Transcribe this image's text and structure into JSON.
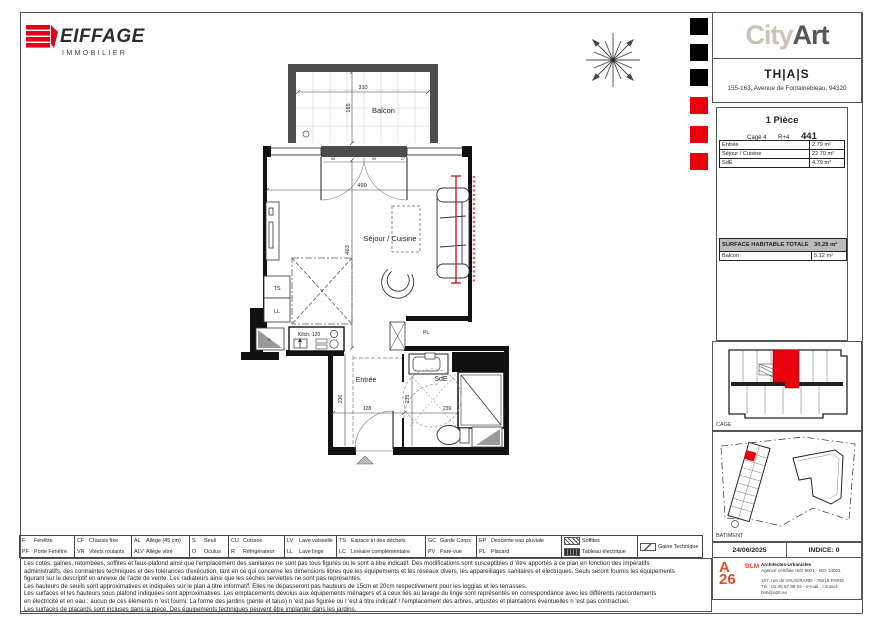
{
  "brand": {
    "name": "EIFFAGE",
    "sub": "IMMOBILIER"
  },
  "project": {
    "name_light": "City",
    "name_dark": "Art",
    "residence": "TH|A|S",
    "address": "155-163, Avenue de Fontainebleau, 94320"
  },
  "unit": {
    "type": "1 Pièce",
    "cage": "Cage 4",
    "floor": "R+4",
    "number": "441",
    "rooms": [
      {
        "name": "Entrée",
        "area": "2.79 m²"
      },
      {
        "name": "Séjour / Cuisine",
        "area": "22.70 m²"
      },
      {
        "name": "SdE",
        "area": "4.79 m²"
      }
    ],
    "total_label": "SURFACE HABITABLE TOTALE",
    "total_area": "30.28 m²",
    "balcony_label": "Balcon",
    "balcony_area": "5.12 m²"
  },
  "plan": {
    "rooms": {
      "balcon": "Balcon",
      "sejour": "Séjour / Cuisine",
      "entree": "Entrée",
      "sde": "SdE"
    },
    "tags": {
      "ts": "TS",
      "ll": "LL",
      "pl": "PL",
      "s": "S",
      "kitchen": "Kitch. 120"
    },
    "dims": {
      "balcon_w": "310",
      "balcon_d": "165",
      "sejour_w": "499",
      "sejour_d": "463",
      "entree_d": "236",
      "entree_w": "128",
      "sde_d": "235",
      "sde_w": "239",
      "bay_1": "98",
      "bay_2": "90",
      "bay_3": "27"
    }
  },
  "keyplans": {
    "cage_label": "CAGE",
    "batiment_label": "BATIMENT"
  },
  "titleblock": {
    "date": "24/06/2025",
    "indice": "INDICE: 0"
  },
  "architect": {
    "logo_a": "A",
    "logo_26": "26",
    "blm": "BLM",
    "line1": "Architectes-Urbanistes",
    "line2": "Agence certifiée ISO 9001 - ISO 14001",
    "line3": "167, rue de VAUGIRARD - 75015 PARIS",
    "line4": "Tél : 01 45 67 89 02 - e-mail : contact-blm@a26.eu"
  },
  "legend": {
    "cols": [
      {
        "rows": [
          {
            "abbr": "F",
            "label": "Fenêtre"
          },
          {
            "abbr": "PF",
            "label": "Porte Fenêtre"
          }
        ]
      },
      {
        "rows": [
          {
            "abbr": "CF",
            "label": "Chassis fixe"
          },
          {
            "abbr": "VR",
            "label": "Volets roulants"
          }
        ]
      },
      {
        "rows": [
          {
            "abbr": "AL",
            "label": "Allège (45 cm)"
          },
          {
            "abbr": "ALV",
            "label": "Allège vitré"
          }
        ]
      },
      {
        "rows": [
          {
            "abbr": "S",
            "label": "Seuil"
          },
          {
            "abbr": "O",
            "label": "Oculus"
          }
        ]
      },
      {
        "rows": [
          {
            "abbr": "CU",
            "label": "Cuisson"
          },
          {
            "abbr": "R",
            "label": "Réfrigérateur"
          }
        ]
      },
      {
        "rows": [
          {
            "abbr": "LV",
            "label": "Lave vaisselle"
          },
          {
            "abbr": "LL",
            "label": "Lave linge"
          }
        ]
      },
      {
        "rows": [
          {
            "abbr": "TS",
            "label": "Espace tri des déchets"
          },
          {
            "abbr": "LC",
            "label": "Linéaire complémentaire"
          }
        ]
      },
      {
        "rows": [
          {
            "abbr": "GC",
            "label": "Garde Corps"
          },
          {
            "abbr": "PV",
            "label": "Pare-vue"
          }
        ]
      },
      {
        "rows": [
          {
            "abbr": "EP",
            "label": "Descente eau pluviale"
          },
          {
            "abbr": "PL",
            "label": "Placard"
          }
        ]
      },
      {
        "rows": [
          {
            "abbr": "",
            "label": "Soffites"
          },
          {
            "abbr": "",
            "label": "Tableau électrique"
          }
        ]
      },
      {
        "rows": [
          {
            "abbr": "",
            "label": "Gaine Technique"
          }
        ]
      }
    ]
  },
  "disclaimer": {
    "lines": [
      "Les cotes, gaines, retombées, soffites et faux-plafond ainsi que l'emplacement des sanitaires ne sont pas tous figurés ou le sont à titre indicatif. Des modifications sont susceptibles d 'être apportés à ce plan en fonction des impératifs",
      "administratifs, des contraintes techniques et des tolérances d'exécution, tant en ce qui concerne les dimensions libres que les équipements et les réseaux divers, les appareillages sanitaires et électriques. Seuls seront fournis les équipements",
      "figurant sur le descriptif en annexe de l'acte de vente. Les radiateurs ainsi que les sèches serviettes ne sont pas représentés.",
      "Les hauteurs de seuils sont approximatives et indiquées sur le plan à titre informatif. Elles ne dépasseront pas hauteurs de 15cm et 20cm respectivement pour les loggias et les terrasses.",
      "Les surfaces et les hauteurs sous plafond indiquées sont approximatives. Les emplacements dévolus aux équipements ménagers et à ceux liés au lavage du linge sont représentés en correspondance avec les différents raccordements",
      "en électricité et en eau ; aucun de ces éléments n 'est fourni. La forme des jardins (pente et talus) n 'est pas figurée ou l 'est à titre indicatif ! l'emplacement des arbres, arbustes et plantations éventuelles n 'est pas contractuel.",
      "Les surfaces de placards sont incluses dans la pièce. Des équipements techniques peuvent être implanter dans les jardins."
    ]
  },
  "colors": {
    "brand_red": "#e2001a",
    "accent_red": "#e8000f",
    "city": "#c9c3b3",
    "art": "#55565a",
    "wall": "#4d4d4d",
    "total_row_bg": "#bcbcbc"
  }
}
